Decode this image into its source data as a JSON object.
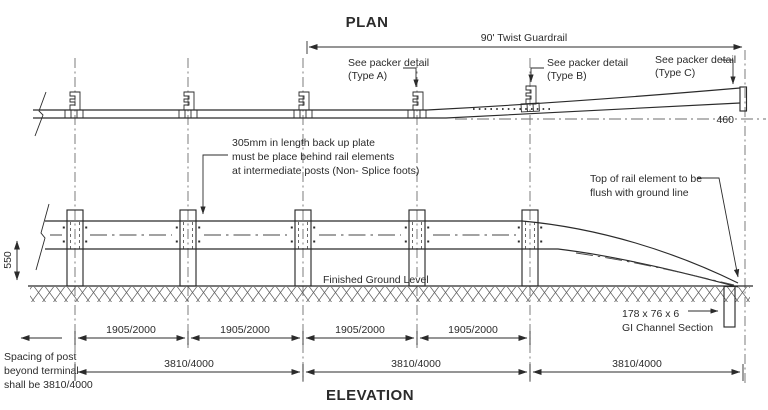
{
  "colors": {
    "ink": "#2b2b2b",
    "centerline": "#6e6e6e",
    "background": "#ffffff"
  },
  "plan": {
    "title": "PLAN",
    "guardrail_dim": "90' Twist Guardrail",
    "packer_a_1": "See packer detail",
    "packer_a_2": "(Type A)",
    "packer_b_1": "See packer detail",
    "packer_b_2": "(Type B)",
    "packer_c_1": "See packer detail",
    "packer_c_2": "(Type C)",
    "end_width": "460"
  },
  "elevation": {
    "title": "ELEVATION",
    "rail_height": "550",
    "note_backup_1": "305mm in length back up plate",
    "note_backup_2": "must be place behind rail elements",
    "note_backup_3": "at intermediate posts (Non- Splice foots)",
    "ground_level": "Finished Ground Level",
    "note_flush_1": "Top of rail element to be",
    "note_flush_2": "flush with ground line",
    "channel_1": "178 x 76 x 6",
    "channel_2": "GI Channel Section",
    "spacing_1": "Spacing of post",
    "spacing_2": "beyond terminal",
    "spacing_3": "shall be 3810/4000"
  },
  "dimensions": {
    "post_spans": [
      "1905/2000",
      "1905/2000",
      "1905/2000",
      "1905/2000"
    ],
    "panel_spans": [
      "3810/4000",
      "3810/4000",
      "3810/4000"
    ]
  }
}
